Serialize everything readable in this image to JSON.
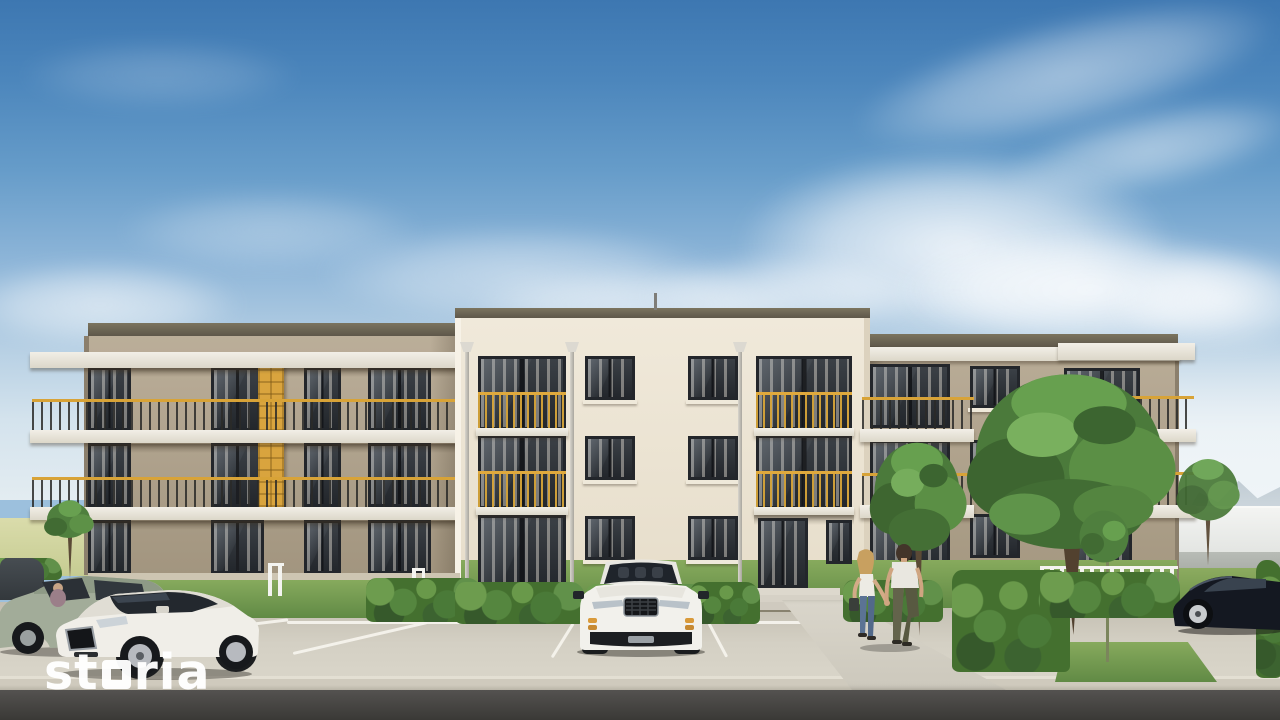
{
  "watermark": {
    "full_text": "storia",
    "prefix": "st",
    "suffix": "ria",
    "color": "#ffffff"
  },
  "scene": {
    "setting": "exterior architectural rendering of a three-story apartment building with parking lot",
    "building": {
      "floors_visible": 3,
      "sections": [
        "left-wing-with-continuous-balconies",
        "central-entrance-block",
        "right-wing-with-corner-balconies"
      ],
      "entrance": "glass entrance door with concrete steps",
      "balcony_accent": "gold railings and yellow privacy screens"
    },
    "vehicles": [
      {
        "label": "dark hatchback, far left, partially visible"
      },
      {
        "label": "sage green hatchback with driver inside"
      },
      {
        "label": "white hatchback, three-quarter view"
      },
      {
        "label": "white SUV parked facing viewer, center stall"
      },
      {
        "label": "black coupe at right edge"
      }
    ],
    "people": [
      {
        "label": "woman walking, blonde, white top, blue jeans, dark bag"
      },
      {
        "label": "man walking, white t-shirt, olive trousers"
      }
    ],
    "landscape": [
      "blue sky with wispy clouds",
      "lawns",
      "trimmed hedges",
      "trees and sapling",
      "parking stalls with white lines",
      "concrete walkway and curb",
      "asphalt road",
      "white picket fence",
      "distant hills and wall at right",
      "pale field at far left"
    ]
  },
  "palette": {
    "sky_top": "#3d77b1",
    "sky_horizon": "#e3ecf1",
    "facade_wings": "#b2a490",
    "facade_center": "#ece4d3",
    "railing_gold": "#d8a337",
    "yellow_panel": "#d9a43e",
    "window_glass": "#2c3036",
    "hedge_green": "#44702f",
    "lawn_green": "#6f9a50",
    "pavement": "#cdc8bc",
    "asphalt": "#43423f",
    "suv_white": "#f1efe9",
    "coupe_black": "#141821"
  }
}
